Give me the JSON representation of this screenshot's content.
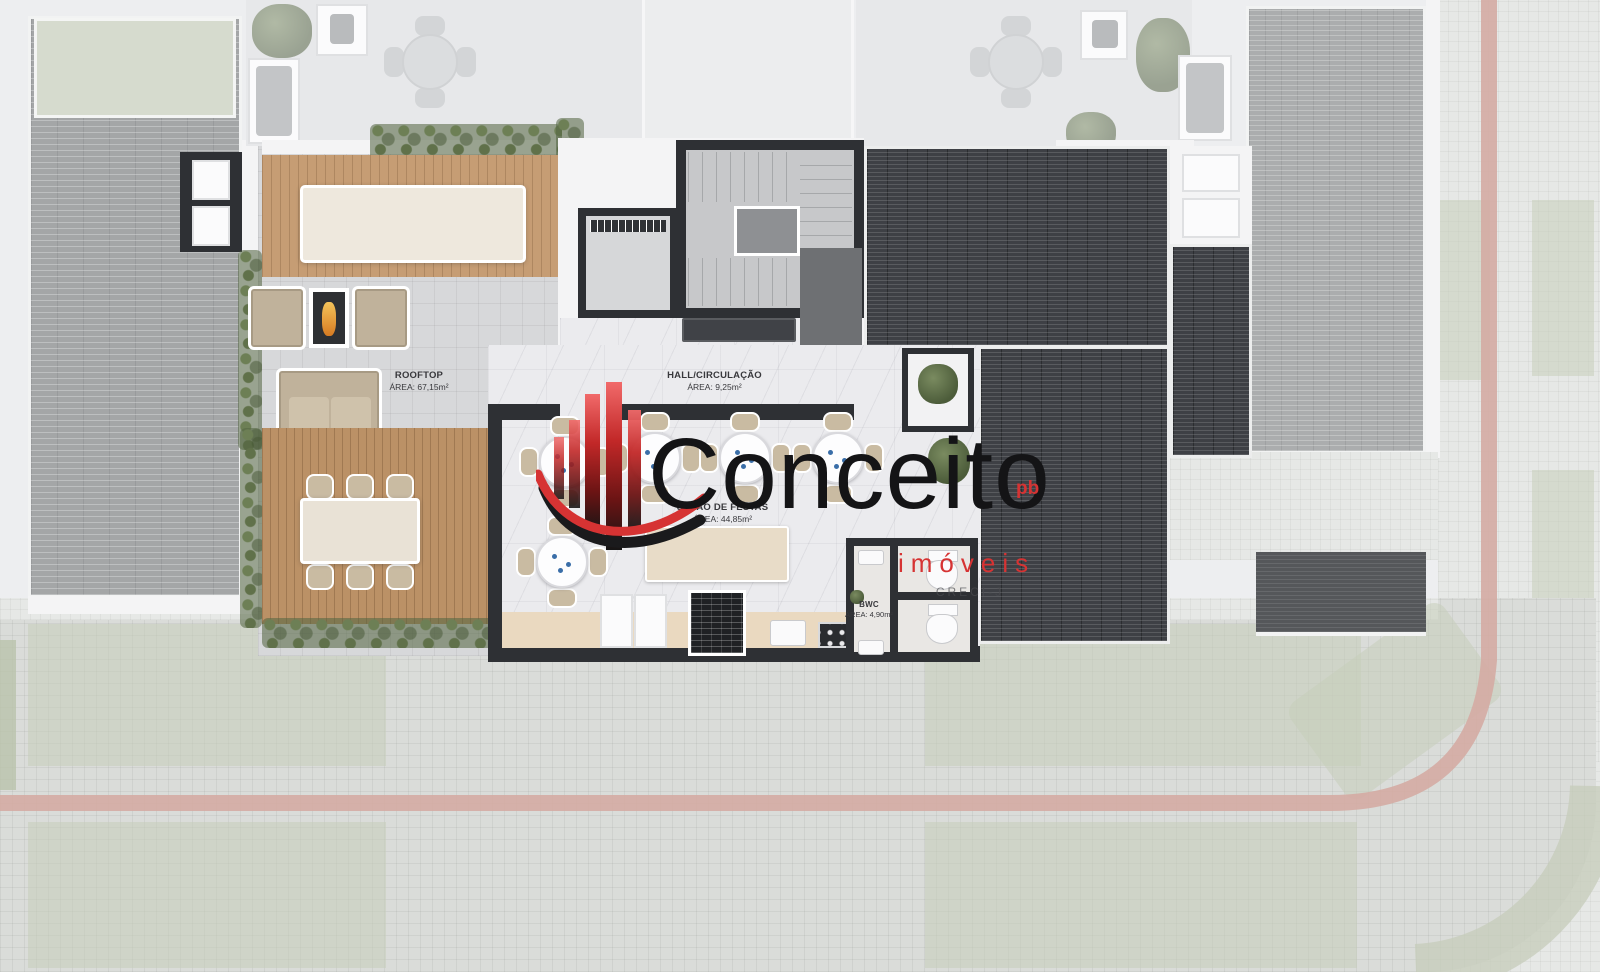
{
  "document": {
    "type": "architectural floor plan rendering",
    "view": "rooftop top view"
  },
  "watermark": {
    "brand": "Conceito",
    "superscript": "pb",
    "subtitle": "imóveis",
    "registration": "CRECI-J",
    "colors": {
      "brand_text": "#141416",
      "accent_red": "#d63333"
    }
  },
  "rooms": {
    "rooftop": {
      "name": "ROOFTOP",
      "area": "ÁREA: 67,15m²"
    },
    "hall": {
      "name": "HALL/CIRCULAÇÃO",
      "area": "ÁREA: 9,25m²"
    },
    "salao_de_festas": {
      "name": "SALÃO DE FESTAS",
      "area": "ÁREA: 44,85m²"
    },
    "bwc": {
      "name": "BWC",
      "area": "ÁREA: 4,90m²"
    }
  },
  "palette": {
    "dark_roof": "#3e4045",
    "gray_brick_roof": "#a4a6a7",
    "wood_deck": "#c69d74",
    "lawn": "#41512f",
    "plaza_paver": "#dadcd9",
    "pink_path": "#d4aba3",
    "wall_dark": "#2e3034"
  }
}
